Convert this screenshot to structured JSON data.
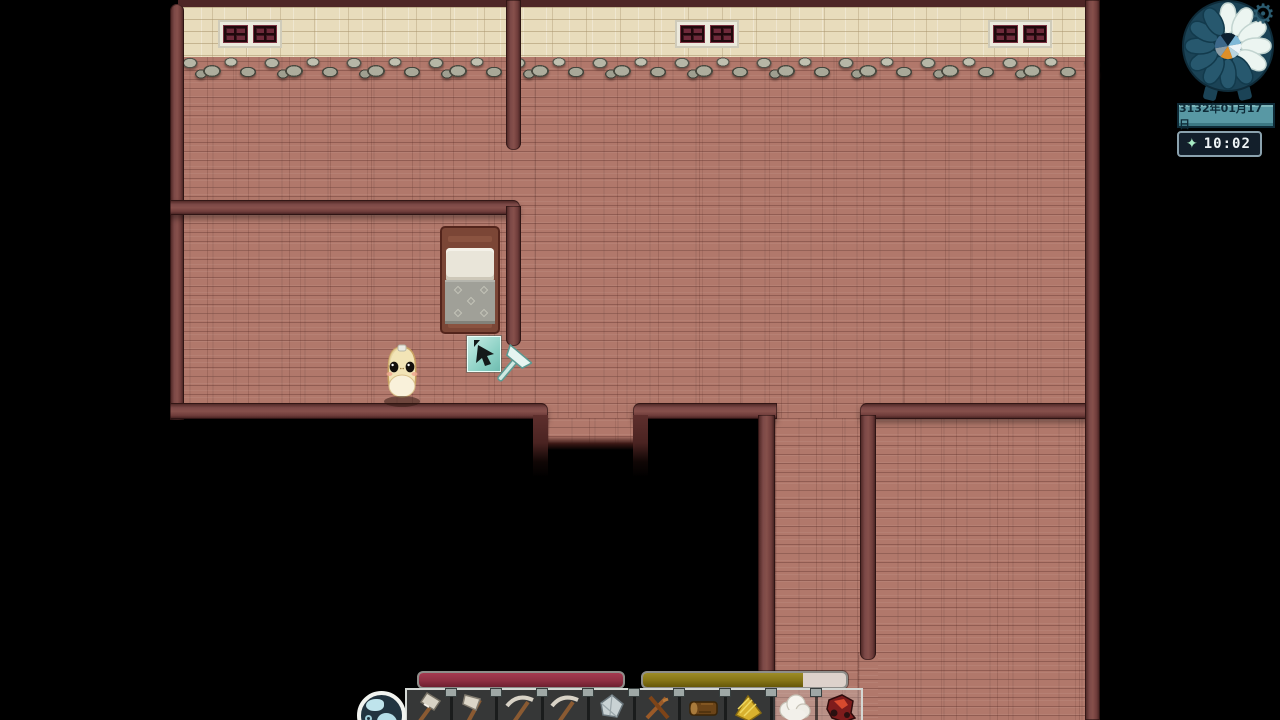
{
  "hud": {
    "clock": {
      "total_petals": 12,
      "lit_petals": 5
    },
    "icons": {
      "gear": "⚙",
      "sparkle": "✦"
    },
    "date_label": "3132年01月17日",
    "time_label": "10:02",
    "health": {
      "percent": 100,
      "color": "#8e2f42"
    },
    "stamina": {
      "percent": 79,
      "color": "#857416"
    },
    "hotbar": {
      "items": [
        "hammer",
        "axe",
        "pickaxe",
        "pickaxe",
        "flint",
        "sticks",
        "log",
        "wheat",
        "wool",
        "meat"
      ],
      "orb_icon": "world-orb"
    }
  },
  "world": {
    "cursor_tool": "axe",
    "objects": [
      "bed",
      "creature"
    ]
  },
  "colors": {
    "floor": "#b1786b",
    "upper_wall": "#e8dcbc",
    "interior_wall": "#7c4947",
    "health": "#8e2f42",
    "stamina": "#857416",
    "ui_teal": "#5898a4",
    "ui_navy": "#131f2b"
  }
}
